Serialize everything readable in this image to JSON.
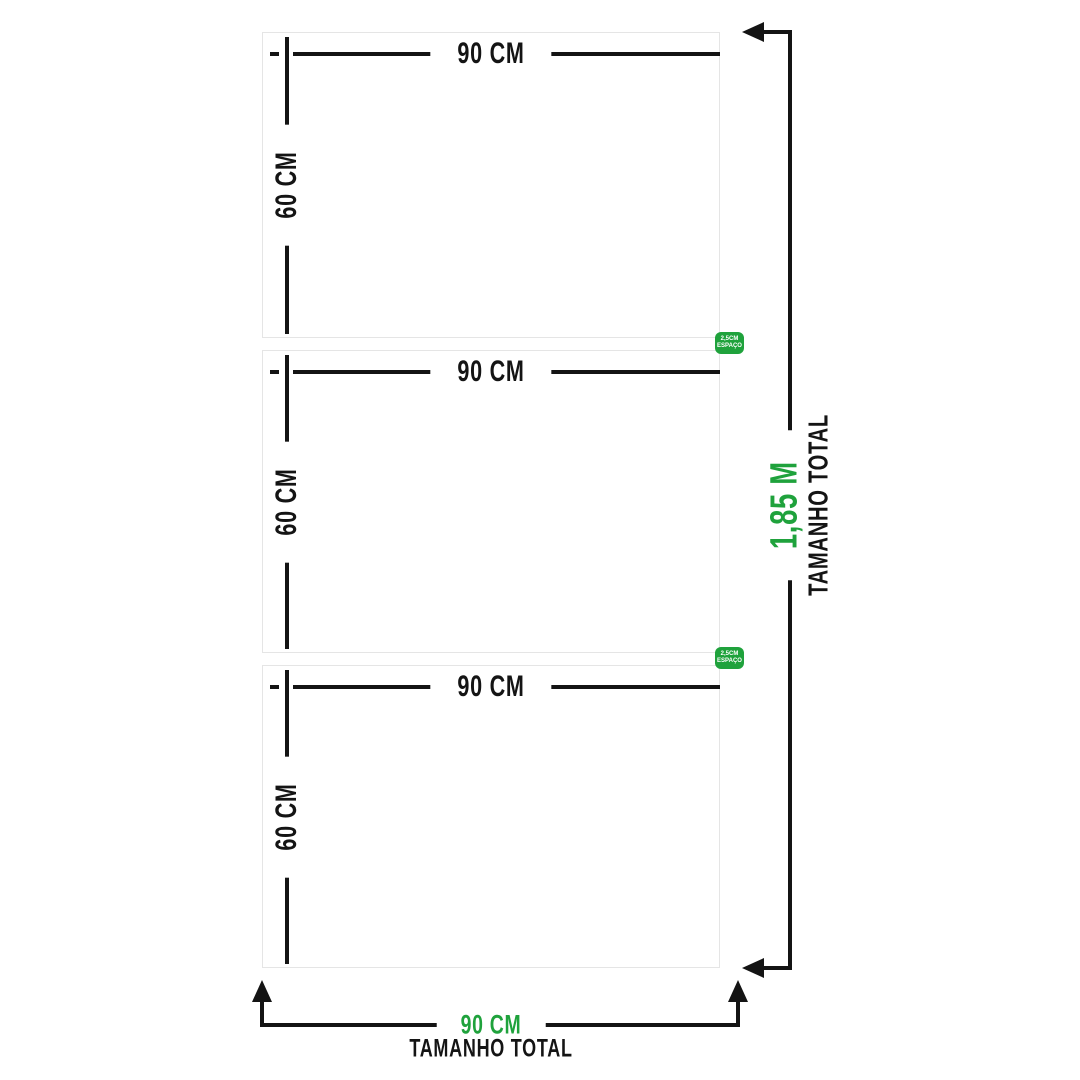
{
  "colors": {
    "accent_green": "#1fa23c",
    "line_black": "#141414",
    "panel_border": "#e5e5e5",
    "background": "#ffffff"
  },
  "panels": [
    {
      "width_label": "90 CM",
      "height_label": "60 CM"
    },
    {
      "width_label": "90 CM",
      "height_label": "60 CM"
    },
    {
      "width_label": "90 CM",
      "height_label": "60 CM"
    }
  ],
  "spacing_badges": [
    {
      "line1": "2,5CM",
      "line2": "ESPAÇO"
    },
    {
      "line1": "2,5CM",
      "line2": "ESPAÇO"
    }
  ],
  "total_height": {
    "value": "1,85 M",
    "label": "TAMANHO TOTAL"
  },
  "total_width": {
    "value": "90 CM",
    "label": "TAMANHO TOTAL"
  }
}
